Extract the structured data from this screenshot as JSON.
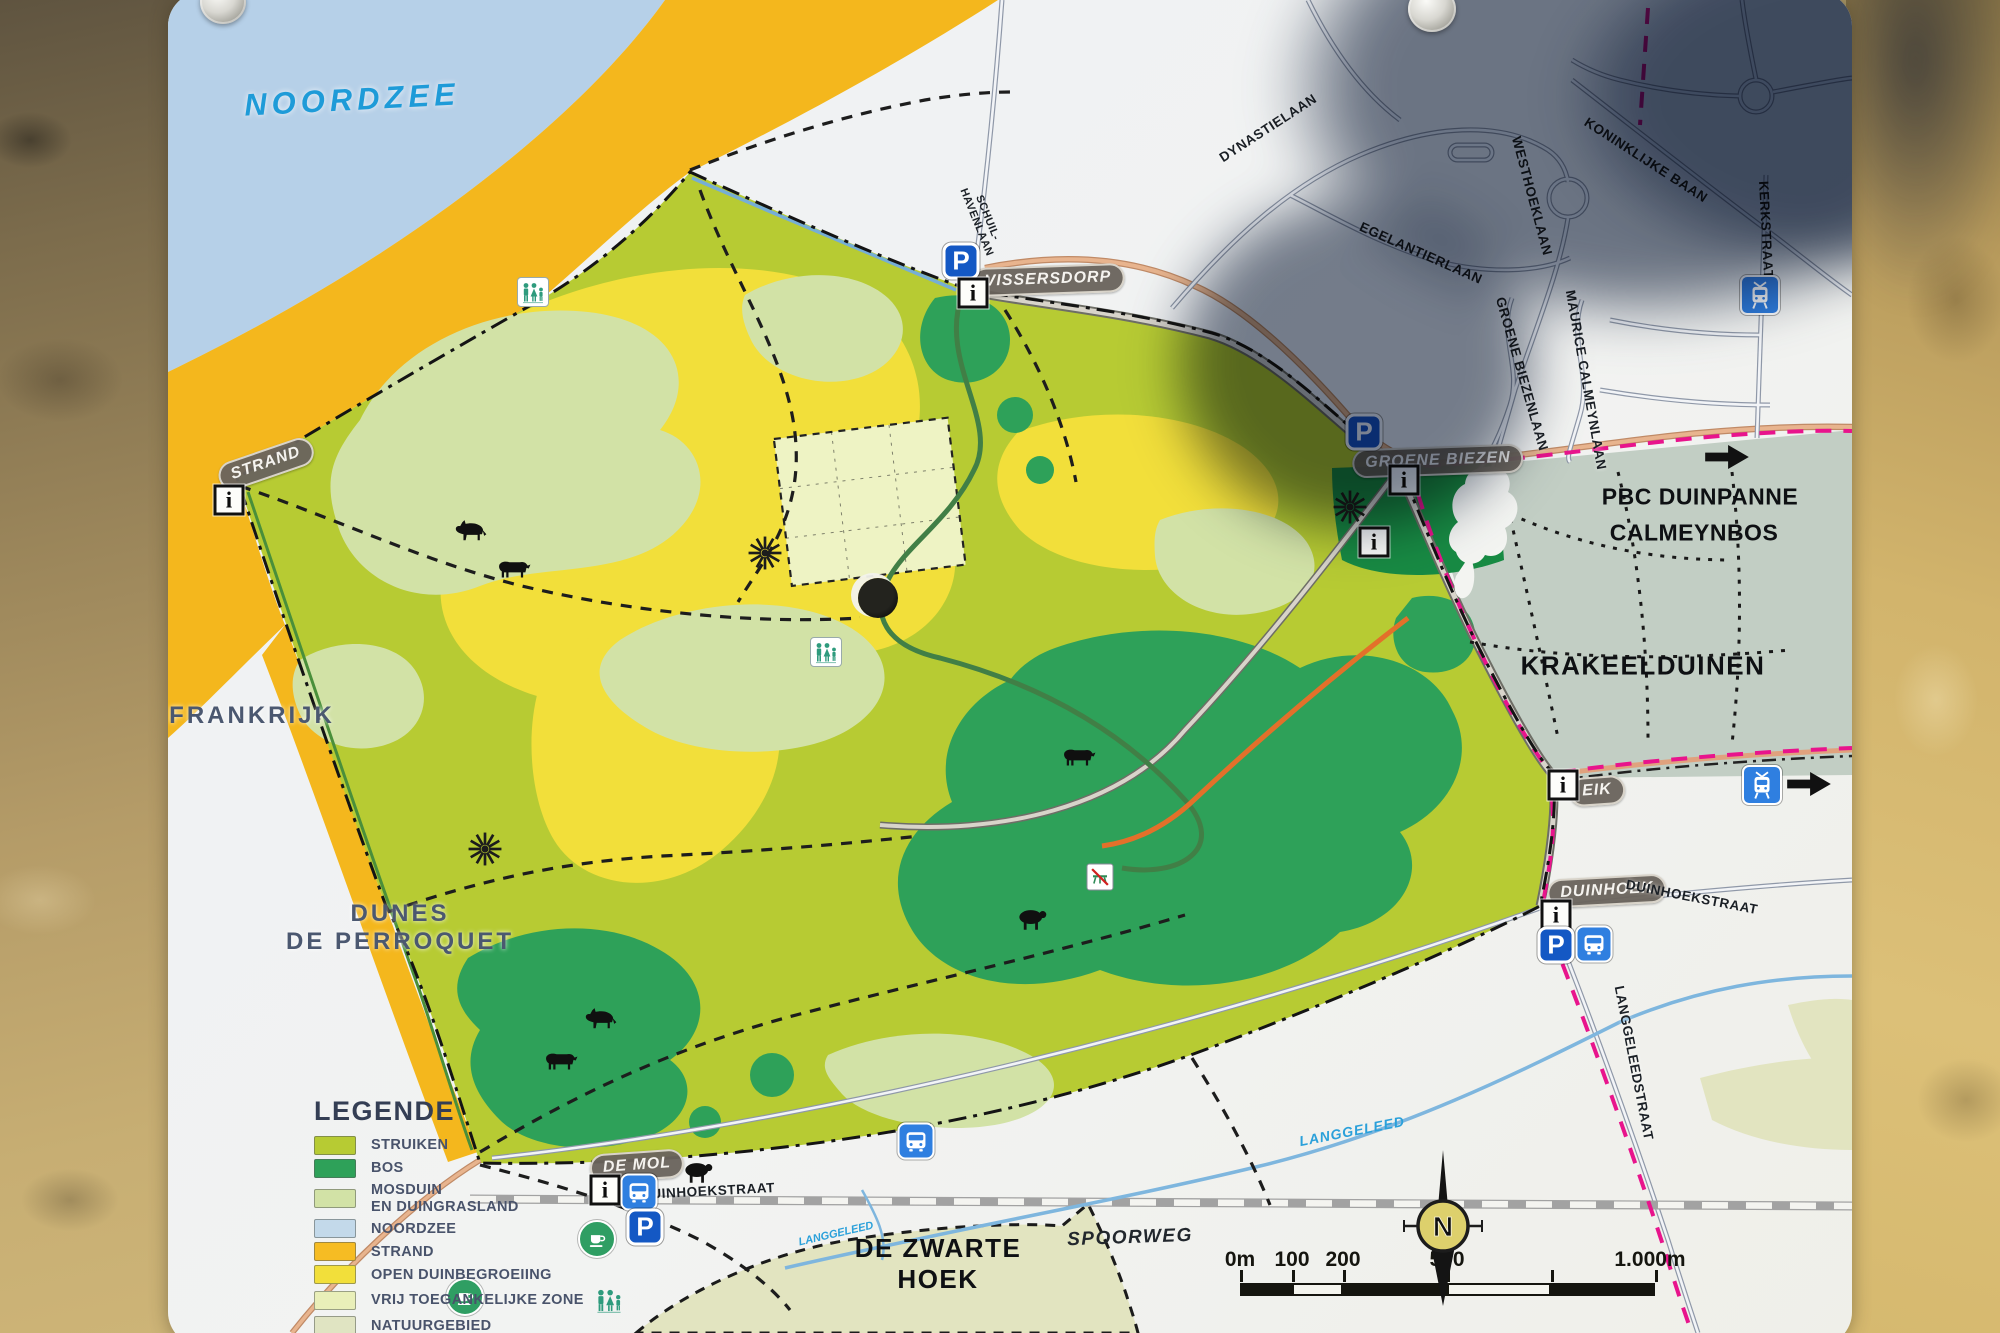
{
  "sign": {
    "type": "nature-reserve trail map panel"
  },
  "map": {
    "labels": [
      {
        "name": "noordzee-label",
        "text": "NOORDZEE",
        "x": 352,
        "y": 100,
        "rot": -3,
        "style": "sea"
      },
      {
        "name": "strand-pill",
        "text": "STRAND",
        "x": 266,
        "y": 464,
        "rot": -19,
        "style": "pill"
      },
      {
        "name": "vissersdorp-pill",
        "text": "VISSERSDORP",
        "x": 1048,
        "y": 280,
        "rot": -2,
        "style": "pill"
      },
      {
        "name": "groene-biezen-pill",
        "text": "GROENE BIEZEN",
        "x": 1438,
        "y": 461,
        "rot": -2,
        "style": "pill"
      },
      {
        "name": "eik-pill",
        "text": "EIK",
        "x": 1597,
        "y": 791,
        "rot": -4,
        "style": "pill"
      },
      {
        "name": "duinhoek-pill",
        "text": "DUINHOEK",
        "x": 1607,
        "y": 891,
        "rot": -3,
        "style": "pill"
      },
      {
        "name": "de-mol-pill",
        "text": "DE MOL",
        "x": 637,
        "y": 1166,
        "rot": -4,
        "style": "pill"
      },
      {
        "name": "frankrijk-label",
        "text": "FRANKRIJK",
        "x": 252,
        "y": 716,
        "rot": 0,
        "style": "region"
      },
      {
        "name": "dunes-de-perroquet-label",
        "text": "DUNES\nDE PERROQUET",
        "x": 400,
        "y": 928,
        "rot": 0,
        "style": "region"
      },
      {
        "name": "pbc-duinpanne-label",
        "text": "PBC DUINPANNE",
        "x": 1700,
        "y": 497,
        "rot": 0,
        "style": "place"
      },
      {
        "name": "calmeynbos-label",
        "text": "CALMEYNBOS",
        "x": 1694,
        "y": 533,
        "rot": 0,
        "style": "place"
      },
      {
        "name": "krakeelduinen-label",
        "text": "KRAKEELDUINEN",
        "x": 1643,
        "y": 666,
        "rot": 0,
        "style": "place-lg"
      },
      {
        "name": "de-zwarte-hoek-label",
        "text": "DE ZWARTE\nHOEK",
        "x": 938,
        "y": 1264,
        "rot": 0,
        "style": "place-lg"
      },
      {
        "name": "dynastielaan-street",
        "text": "DYNASTIELAAN",
        "x": 1268,
        "y": 128,
        "rot": -33,
        "style": "street"
      },
      {
        "name": "koninklijke-baan-street",
        "text": "KONINKLIJKE BAAN",
        "x": 1646,
        "y": 160,
        "rot": 33,
        "style": "street"
      },
      {
        "name": "westhoeklaan-street",
        "text": "WESTHOEKLAAN",
        "x": 1532,
        "y": 196,
        "rot": 75,
        "style": "street"
      },
      {
        "name": "egelantierlaan-street",
        "text": "EGELANTIERLAAN",
        "x": 1421,
        "y": 253,
        "rot": 24,
        "style": "street"
      },
      {
        "name": "groene-biezenlaan-street",
        "text": "GROENE BIEZENLAAN",
        "x": 1522,
        "y": 374,
        "rot": 74,
        "style": "street"
      },
      {
        "name": "maurice-calmeynlaan-street",
        "text": "MAURICE CALMEYNLAAN",
        "x": 1586,
        "y": 380,
        "rot": 80,
        "style": "street"
      },
      {
        "name": "kerkstraat-street",
        "text": "KERKSTRAAT",
        "x": 1766,
        "y": 230,
        "rot": 87,
        "style": "street"
      },
      {
        "name": "schuilhavenlaan-street",
        "text": "SCHUIL-\nHAVENLAAN",
        "x": 982,
        "y": 220,
        "rot": 68,
        "style": "street-sm"
      },
      {
        "name": "duinhoekstraat-east-street",
        "text": "DUINHOEKSTRAAT",
        "x": 1692,
        "y": 897,
        "rot": 11,
        "style": "street"
      },
      {
        "name": "duinhoekstraat-west-street",
        "text": "DUINHOEKSTRAAT",
        "x": 708,
        "y": 1191,
        "rot": -3,
        "style": "street"
      },
      {
        "name": "langgeleedstraat-street",
        "text": "LANGGELEEDSTRAAT",
        "x": 1634,
        "y": 1063,
        "rot": 79,
        "style": "street"
      },
      {
        "name": "spoorweg-label",
        "text": "SPOORWEG",
        "x": 1130,
        "y": 1238,
        "rot": -2,
        "style": "street-it"
      },
      {
        "name": "langgeleed-east-label",
        "text": "LANGGELEED",
        "x": 1352,
        "y": 1131,
        "rot": -11,
        "style": "stream"
      },
      {
        "name": "langgeleed-west-label",
        "text": "LANGGELEED",
        "x": 836,
        "y": 1234,
        "rot": -13,
        "style": "stream-sm"
      }
    ],
    "icons": [
      {
        "type": "info",
        "glyph": "i",
        "x": 229,
        "y": 500
      },
      {
        "type": "parking",
        "glyph": "P",
        "x": 961,
        "y": 261
      },
      {
        "type": "info",
        "glyph": "i",
        "x": 973,
        "y": 293
      },
      {
        "type": "toilets",
        "x": 533,
        "y": 292
      },
      {
        "type": "toilets",
        "x": 826,
        "y": 652
      },
      {
        "type": "parking",
        "glyph": "P",
        "x": 1364,
        "y": 432
      },
      {
        "type": "info",
        "glyph": "i",
        "x": 1404,
        "y": 480
      },
      {
        "type": "info",
        "glyph": "i",
        "x": 1374,
        "y": 542
      },
      {
        "type": "sun",
        "x": 1350,
        "y": 507
      },
      {
        "type": "sun",
        "x": 765,
        "y": 553
      },
      {
        "type": "sun",
        "x": 485,
        "y": 849
      },
      {
        "type": "hole",
        "x": 878,
        "y": 598
      },
      {
        "type": "nopicnic",
        "x": 1100,
        "y": 877
      },
      {
        "type": "info",
        "glyph": "i",
        "x": 1563,
        "y": 785
      },
      {
        "type": "tram",
        "x": 1762,
        "y": 785
      },
      {
        "type": "arrow",
        "x": 1809,
        "y": 784
      },
      {
        "type": "arrow",
        "x": 1727,
        "y": 457
      },
      {
        "type": "tram",
        "x": 1760,
        "y": 295
      },
      {
        "type": "info",
        "glyph": "i",
        "x": 1556,
        "y": 915
      },
      {
        "type": "parking",
        "glyph": "P",
        "x": 1556,
        "y": 945
      },
      {
        "type": "bus",
        "x": 1594,
        "y": 944
      },
      {
        "type": "bus",
        "x": 916,
        "y": 1141
      },
      {
        "type": "info",
        "glyph": "i",
        "x": 605,
        "y": 1190
      },
      {
        "type": "bus",
        "x": 639,
        "y": 1192
      },
      {
        "type": "parking",
        "glyph": "P",
        "x": 645,
        "y": 1227
      },
      {
        "type": "cafe",
        "x": 597,
        "y": 1239
      },
      {
        "type": "cafe",
        "x": 465,
        "y": 1297
      }
    ],
    "animals": [
      {
        "kind": "horse",
        "x": 470,
        "y": 531
      },
      {
        "kind": "cow",
        "x": 513,
        "y": 569
      },
      {
        "kind": "cow",
        "x": 1078,
        "y": 757
      },
      {
        "kind": "sheep",
        "x": 1032,
        "y": 919
      },
      {
        "kind": "horse",
        "x": 600,
        "y": 1019
      },
      {
        "kind": "cow",
        "x": 560,
        "y": 1061
      },
      {
        "kind": "sheep",
        "x": 698,
        "y": 1172
      }
    ]
  },
  "legend": {
    "title": "LEGENDE",
    "items": [
      {
        "label": "STRUIKEN",
        "swatch": "#b7cb33"
      },
      {
        "label": "BOS",
        "swatch": "#2ea159"
      },
      {
        "label": "MOSDUIN\nEN DUINGRASLAND",
        "swatch": "#d2e2a6"
      },
      {
        "label": "NOORDZEE",
        "swatch": "#c3d9ea"
      },
      {
        "label": "STRAND",
        "swatch": "#f6bc23"
      },
      {
        "label": "OPEN DUINBEGROEIING",
        "swatch": "#f2df3a"
      },
      {
        "label": "VRIJ TOEGANKELIJKE ZONE",
        "swatch": "#e9efb9",
        "icon": "people"
      },
      {
        "label": "NATUURGEBIED",
        "swatch": "#e0e4c2"
      },
      {
        "label": "OPENBARE WEGEN",
        "swatch": "road"
      }
    ]
  },
  "scale_bar": {
    "labels": [
      {
        "text": "0m",
        "x": 1240
      },
      {
        "text": "100",
        "x": 1292
      },
      {
        "text": "200",
        "x": 1343
      },
      {
        "text": "500",
        "x": 1447
      },
      {
        "text": "1.000m",
        "x": 1650
      }
    ],
    "segments": [
      {
        "from": 1240,
        "to": 1292,
        "dark": true
      },
      {
        "from": 1292,
        "to": 1343,
        "dark": false
      },
      {
        "from": 1343,
        "to": 1447,
        "dark": true
      },
      {
        "from": 1447,
        "to": 1551,
        "dark": false
      },
      {
        "from": 1551,
        "to": 1655,
        "dark": true
      }
    ]
  },
  "compass": {
    "letter": "N"
  },
  "palette": {
    "sea": "#b6d0e8",
    "strand": "#f4b71d",
    "open_dune": "#f2df3a",
    "struiken": "#b7cb33",
    "bos": "#2ea159",
    "bos_dark": "#178a43",
    "mosduin": "#d2e2a6",
    "vrij_zone": "#eef3c4",
    "natuurgebied": "#e2e4c0",
    "parking_blue": "#1458c4",
    "transit_blue": "#2f7fe0",
    "trail_pink": "#e8148c",
    "trail_orange": "#e3702a",
    "stream_blue": "#7eb6de",
    "pill_bg": "#6a645d"
  }
}
